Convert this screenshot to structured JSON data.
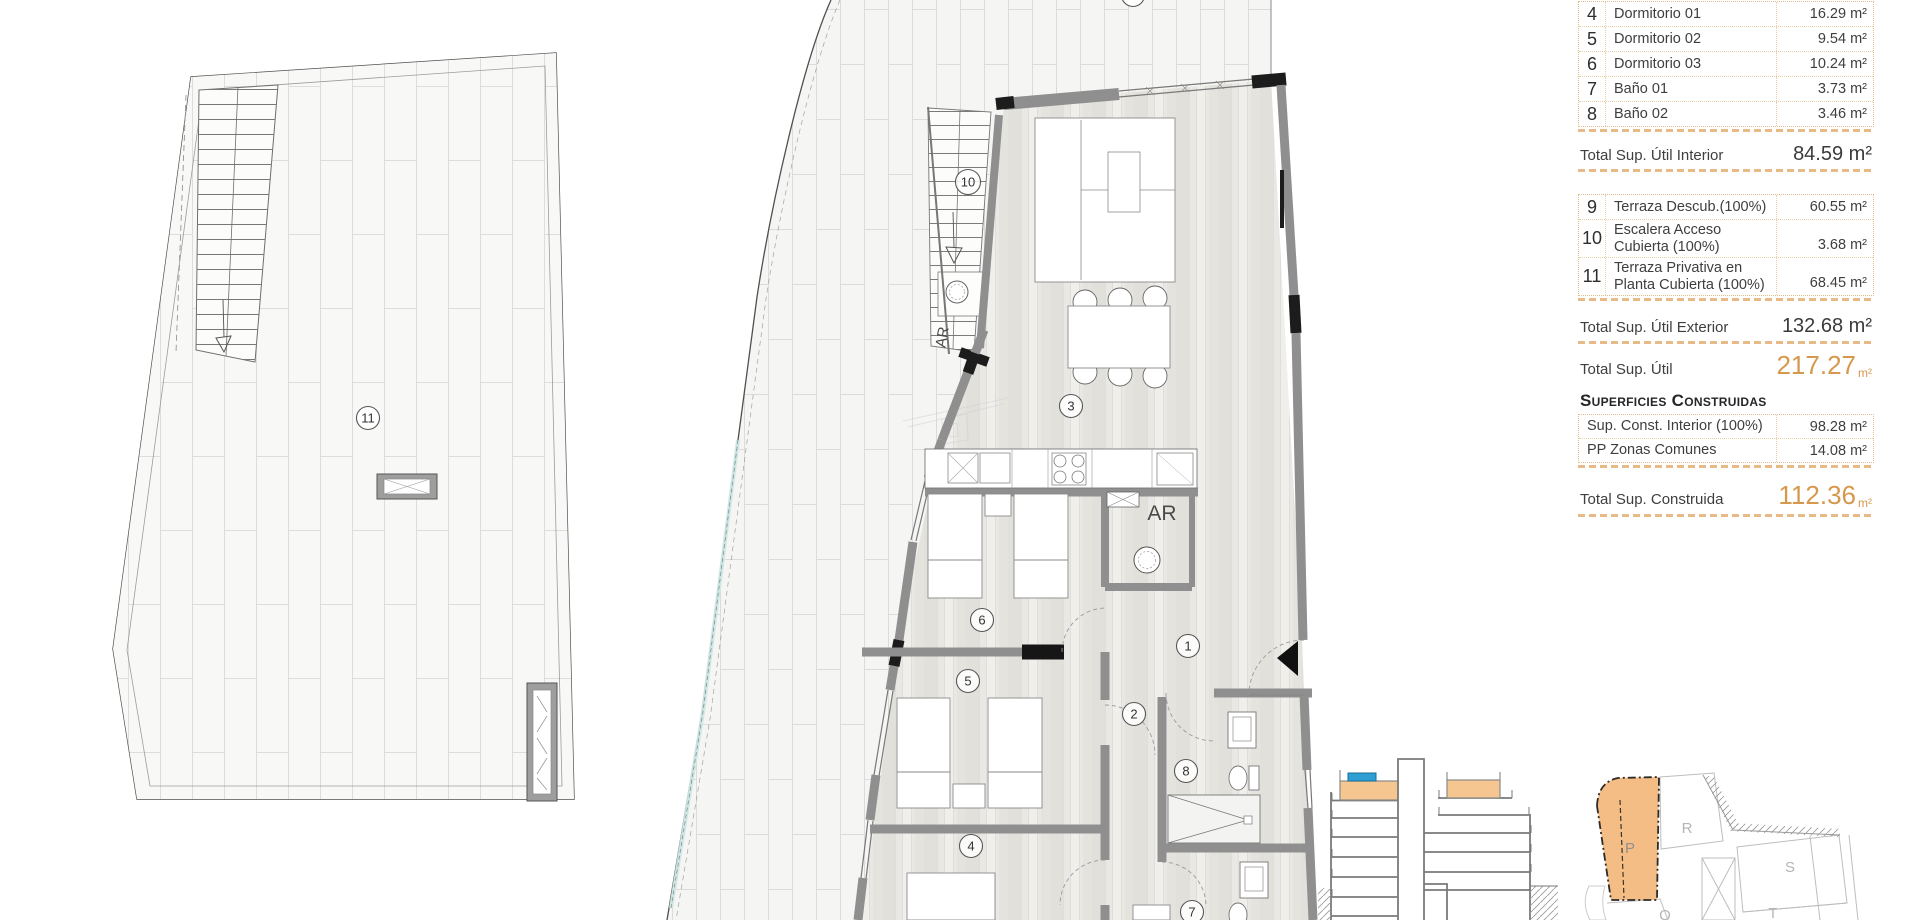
{
  "tables": {
    "interior": {
      "rows": [
        {
          "num": "4",
          "label": "Dormitorio 01",
          "value": "16.29 m²"
        },
        {
          "num": "5",
          "label": "Dormitorio 02",
          "value": "9.54 m²"
        },
        {
          "num": "6",
          "label": "Dormitorio 03",
          "value": "10.24 m²"
        },
        {
          "num": "7",
          "label": "Baño 01",
          "value": "3.73 m²"
        },
        {
          "num": "8",
          "label": "Baño 02",
          "value": "3.46 m²"
        }
      ],
      "total": {
        "label": "Total Sup. Útil Interior",
        "value": "84.59 m²"
      }
    },
    "exterior": {
      "rows": [
        {
          "num": "9",
          "line1": "Terraza Descub.(100%)",
          "line2": "",
          "value": "60.55 m²"
        },
        {
          "num": "10",
          "line1": "Escalera Acceso",
          "line2": "Cubierta (100%)",
          "value": "3.68 m²"
        },
        {
          "num": "11",
          "line1": "Terraza Privativa en",
          "line2": "Planta Cubierta (100%)",
          "value": "68.45 m²"
        }
      ],
      "total": {
        "label": "Total Sup. Útil Exterior",
        "value": "132.68 m²"
      }
    },
    "total_util": {
      "label": "Total Sup. Útil",
      "value": "217.27",
      "unit": "m²"
    },
    "construidas": {
      "header": "Superficies Construidas",
      "rows": [
        {
          "label": "Sup. Const. Interior (100%)",
          "value": "98.28 m²"
        },
        {
          "label": "PP Zonas Comunes",
          "value": "14.08 m²"
        }
      ],
      "total": {
        "label": "Total Sup. Construida",
        "value": "112.36",
        "unit": "m²"
      }
    }
  },
  "floor_plan": {
    "room_labels": [
      {
        "id": "11"
      },
      {
        "id": "10"
      },
      {
        "id": "3"
      },
      {
        "id": "6"
      },
      {
        "id": "5"
      },
      {
        "id": "4"
      },
      {
        "id": "1"
      },
      {
        "id": "2"
      },
      {
        "id": "8"
      },
      {
        "id": "7"
      }
    ],
    "ar_labels": [
      {
        "text": "AR"
      },
      {
        "text": "AR"
      }
    ]
  },
  "site_plan": {
    "labels": [
      "P",
      "R",
      "S",
      "T",
      "Q"
    ]
  },
  "colors": {
    "accent_orange": "#d6984c",
    "dash_orange": "#e7ba87",
    "highlight_fill": "#f3bd85",
    "blue_marker": "#2e9fd4",
    "wall_gray": "#8f8f8f"
  }
}
